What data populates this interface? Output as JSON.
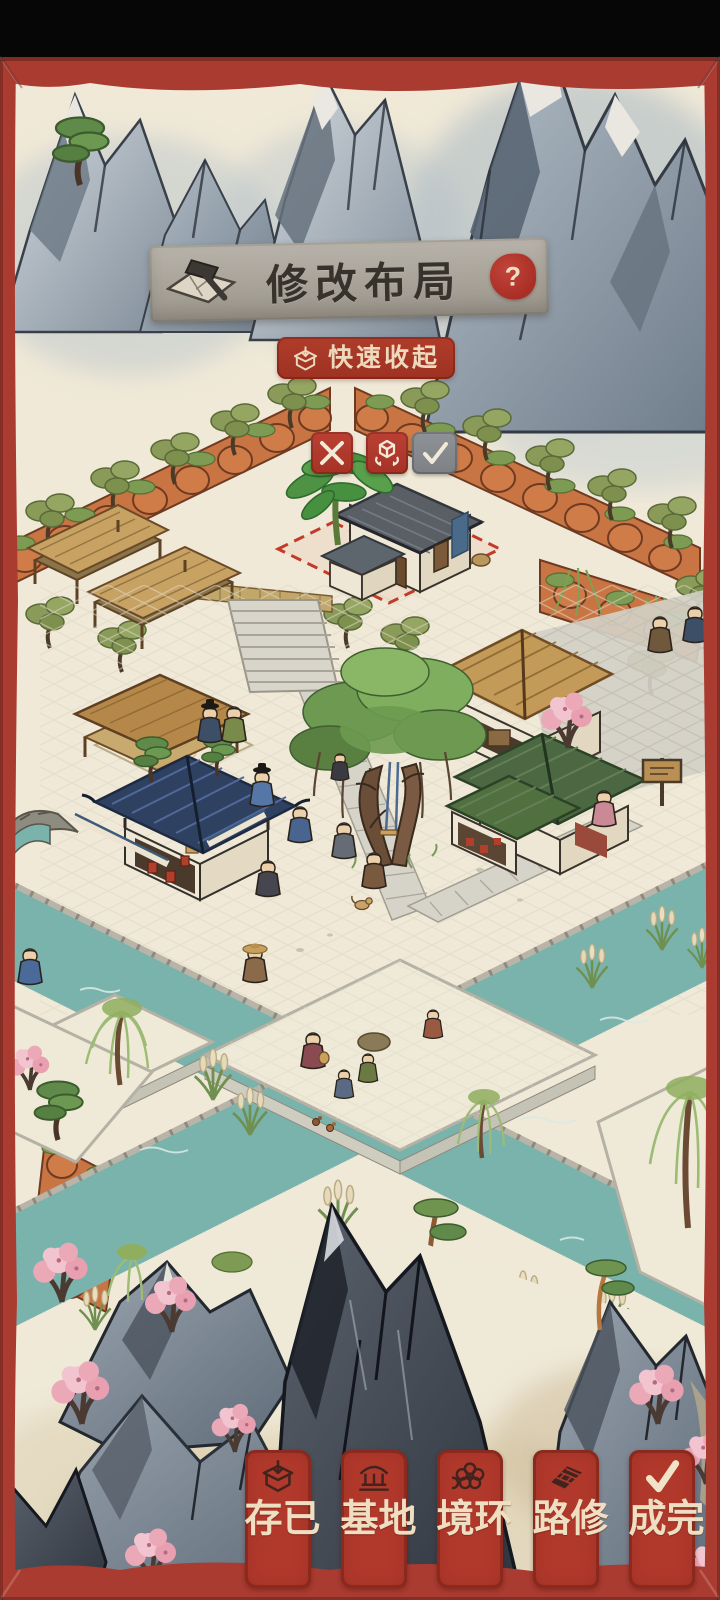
{
  "header": {
    "title": "修改布局",
    "help_label": "?",
    "icon": "layout-hammer-icon"
  },
  "quick_collapse": {
    "label": "快速收起",
    "icon": "storage-box-icon"
  },
  "edit_controls": {
    "cancel": {
      "icon": "x-icon"
    },
    "rotate": {
      "icon": "rotate-cube-icon"
    },
    "confirm": {
      "icon": "check-icon"
    }
  },
  "bottom_bar": {
    "buttons": [
      {
        "id": "saved",
        "label": "已存",
        "icon": "storage-box-icon"
      },
      {
        "id": "foundation",
        "label": "地基",
        "icon": "foundation-house-icon"
      },
      {
        "id": "environment",
        "label": "环境",
        "icon": "blossom-icon"
      },
      {
        "id": "build-road",
        "label": "修路",
        "icon": "road-icon"
      },
      {
        "id": "complete",
        "label": "完成",
        "icon": "check-icon"
      }
    ]
  },
  "colors": {
    "frame_red": "#a93b30",
    "button_red": "#b1392c",
    "banner_grey": "#aaa59c",
    "accent_cream": "#eedfc4",
    "confirm_grey": "#85888b",
    "water_teal": "#7ab3ac",
    "paper": "#f0e9d7",
    "selection_red": "#c23b2a"
  }
}
